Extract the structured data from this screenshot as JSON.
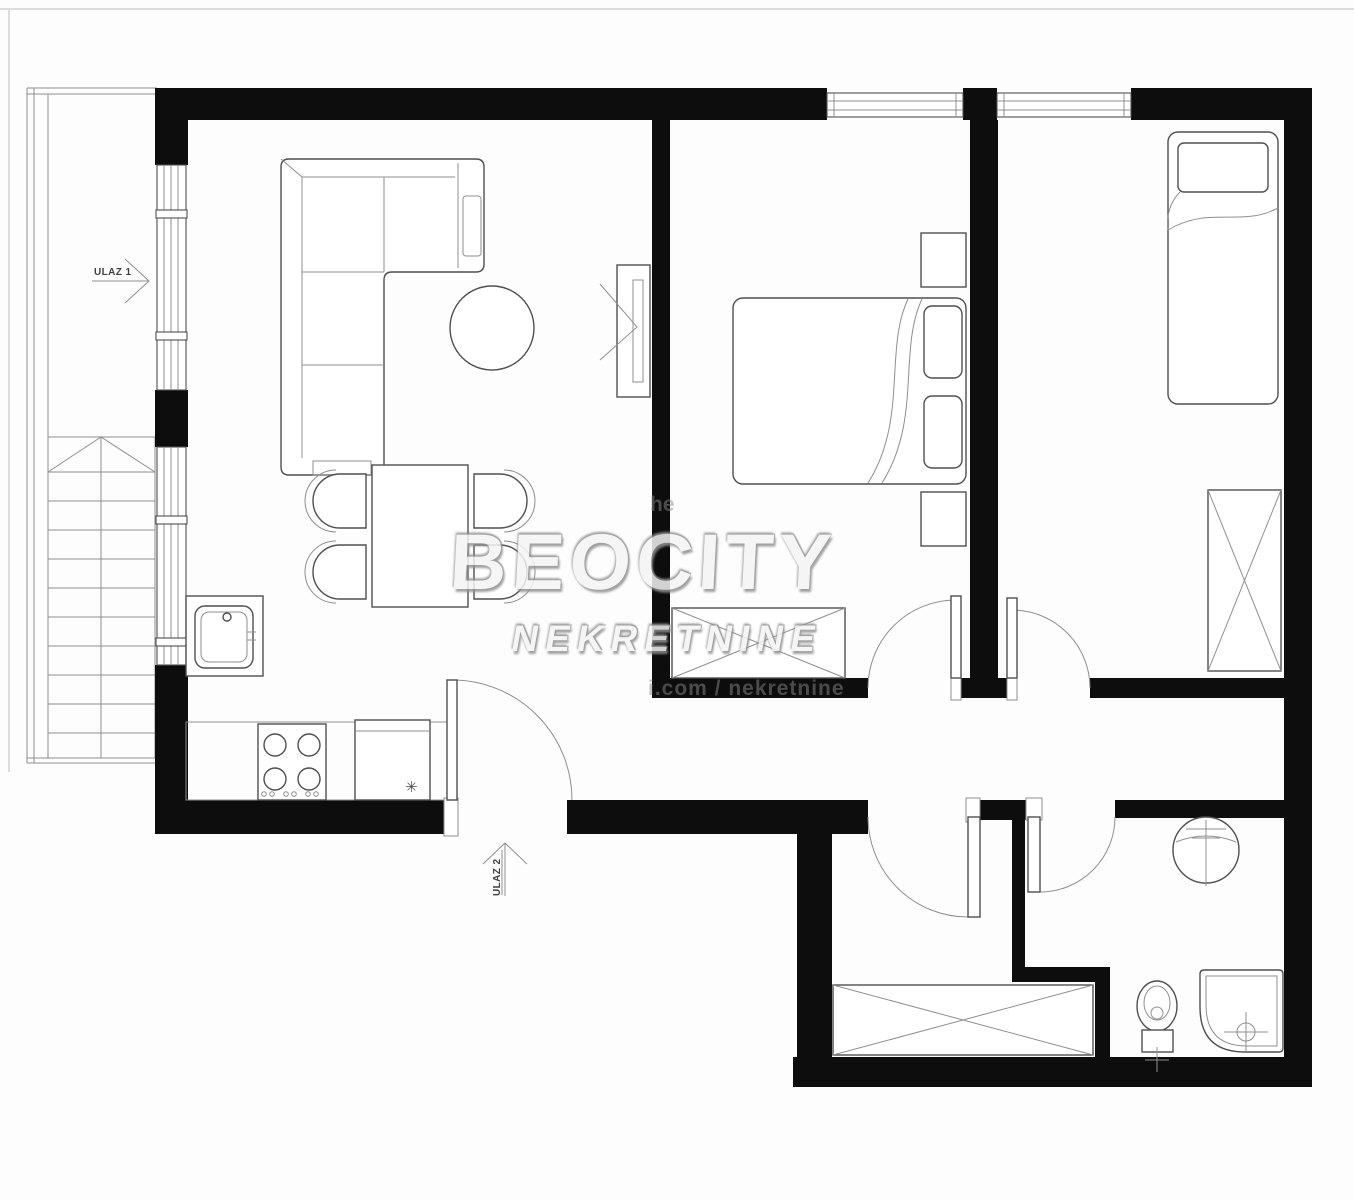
{
  "labels": {
    "entrance1": "ULAZ 1",
    "entrance2": "ULAZ 2"
  },
  "watermark": {
    "brand": "BEOCITY",
    "subtitle": "NEKRETNINE",
    "fragment_top": "he",
    "fragment_bottom": "i.com / nekretnine"
  },
  "kitchen": {
    "appliance_mark": "✳"
  },
  "colors": {
    "wall": "#0d0d0d",
    "line": "#4f4f4f",
    "line_light": "#8f8f8f",
    "background": "#fdfdfd",
    "label": "#3f3f3f",
    "watermark_fill": "#f4f4f4",
    "watermark_shadow": "#909090",
    "edge": "#dddddd"
  },
  "symbols": [
    "staircase",
    "entrance-arrow",
    "window",
    "door-swing",
    "corner-sofa",
    "coffee-table",
    "tv-unit",
    "dining-table",
    "dining-chair",
    "kitchen-sink",
    "stove",
    "refrigerator",
    "double-bed",
    "nightstand",
    "pillow",
    "single-bed",
    "wardrobe",
    "washbasin",
    "toilet",
    "shower-tray"
  ]
}
